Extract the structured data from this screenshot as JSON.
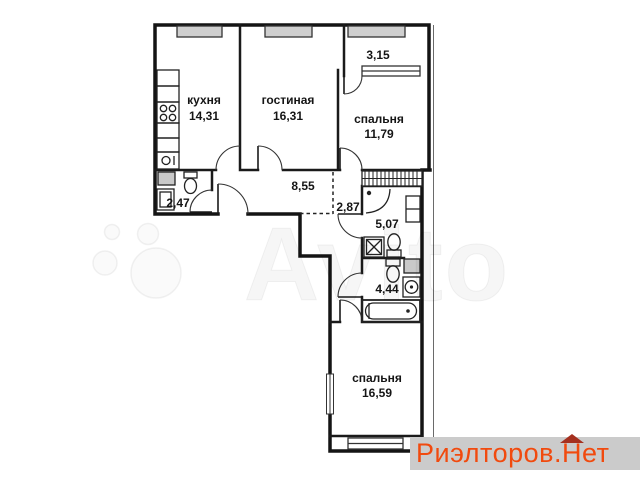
{
  "plan": {
    "rooms": [
      {
        "id": "kitchen",
        "name": "кухня",
        "area": "14,31"
      },
      {
        "id": "living-room",
        "name": "гостиная",
        "area": "16,31"
      },
      {
        "id": "bedroom-top",
        "name": "спальня",
        "area": "11,79"
      },
      {
        "id": "bedroom-bottom",
        "name": "спальня",
        "area": "16,59"
      }
    ],
    "zones": [
      {
        "id": "balcony",
        "area": "3,15"
      },
      {
        "id": "hallway",
        "area": "8,55"
      },
      {
        "id": "wc-small",
        "area": "2,47"
      },
      {
        "id": "corridor",
        "area": "2,87"
      },
      {
        "id": "bathroom",
        "area": "5,07"
      },
      {
        "id": "toilet",
        "area": "4,44"
      }
    ]
  },
  "watermark": {
    "brand": "Avito"
  },
  "logo": {
    "prefix": "Риэлторов.",
    "roof_letter": "Н",
    "suffix": "ет"
  },
  "colors": {
    "wall": "#141414",
    "window_fill": "#cfcfcf",
    "logo_bg": "#cbcbcb",
    "logo_text": "#f14a0e",
    "logo_roof": "#a5301f"
  }
}
